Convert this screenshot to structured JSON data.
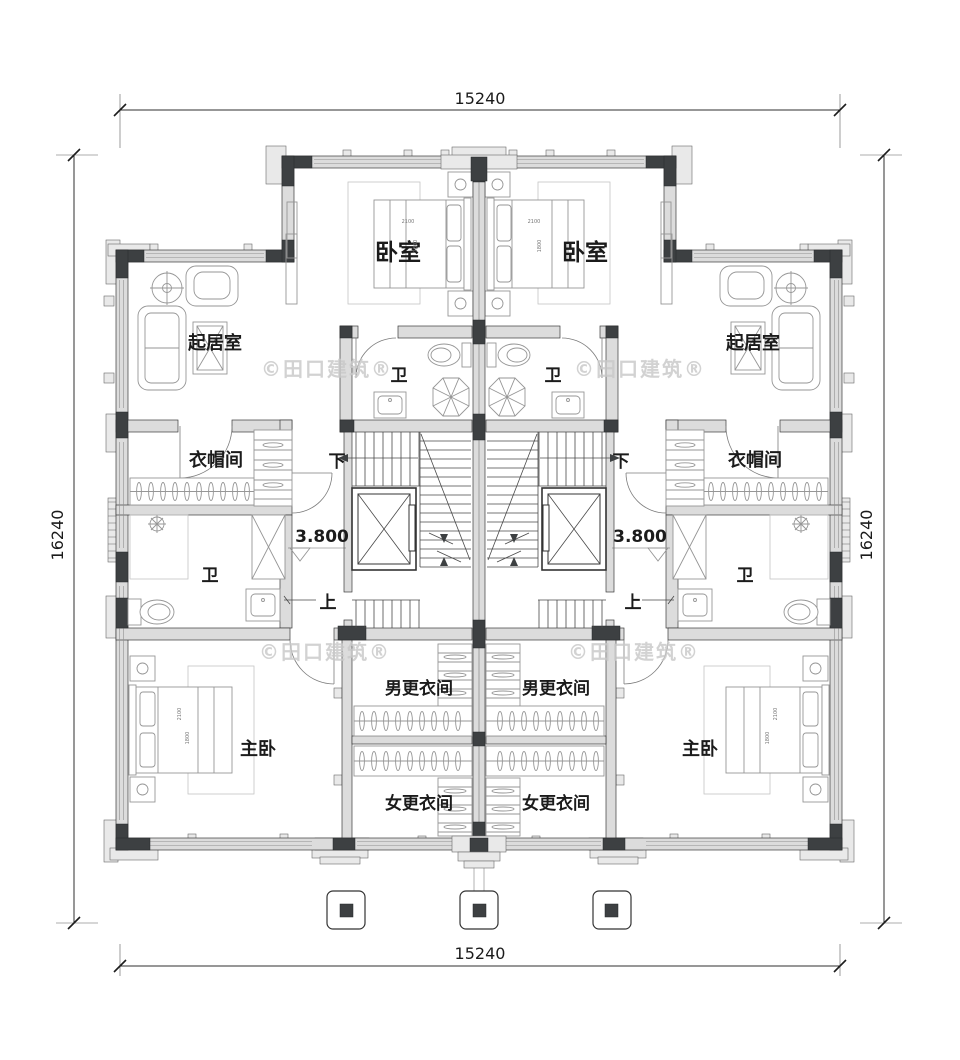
{
  "plan": {
    "dimensions": {
      "top": "15240",
      "bottom": "15240",
      "left": "16240",
      "right": "16240"
    },
    "rooms": {
      "bedroom": "卧室",
      "living_room": "起居室",
      "cloakroom": "衣帽间",
      "bathroom": "卫",
      "master_bedroom": "主卧",
      "dressing_room_male": "男更衣间",
      "dressing_room_female": "女更衣间"
    },
    "stairs": {
      "up": "上",
      "down": "下"
    },
    "level_mark": "3.800",
    "watermark": "©田口建筑®",
    "bed_annotations": {
      "width": "2100",
      "depth": "1800"
    },
    "colors": {
      "wall_dark": "#3d4042",
      "wall_light": "#dcdcdc",
      "line": "#2f2f2f",
      "furniture": "#969696",
      "watermark": "#c9c9c9",
      "background": "#ffffff"
    }
  }
}
